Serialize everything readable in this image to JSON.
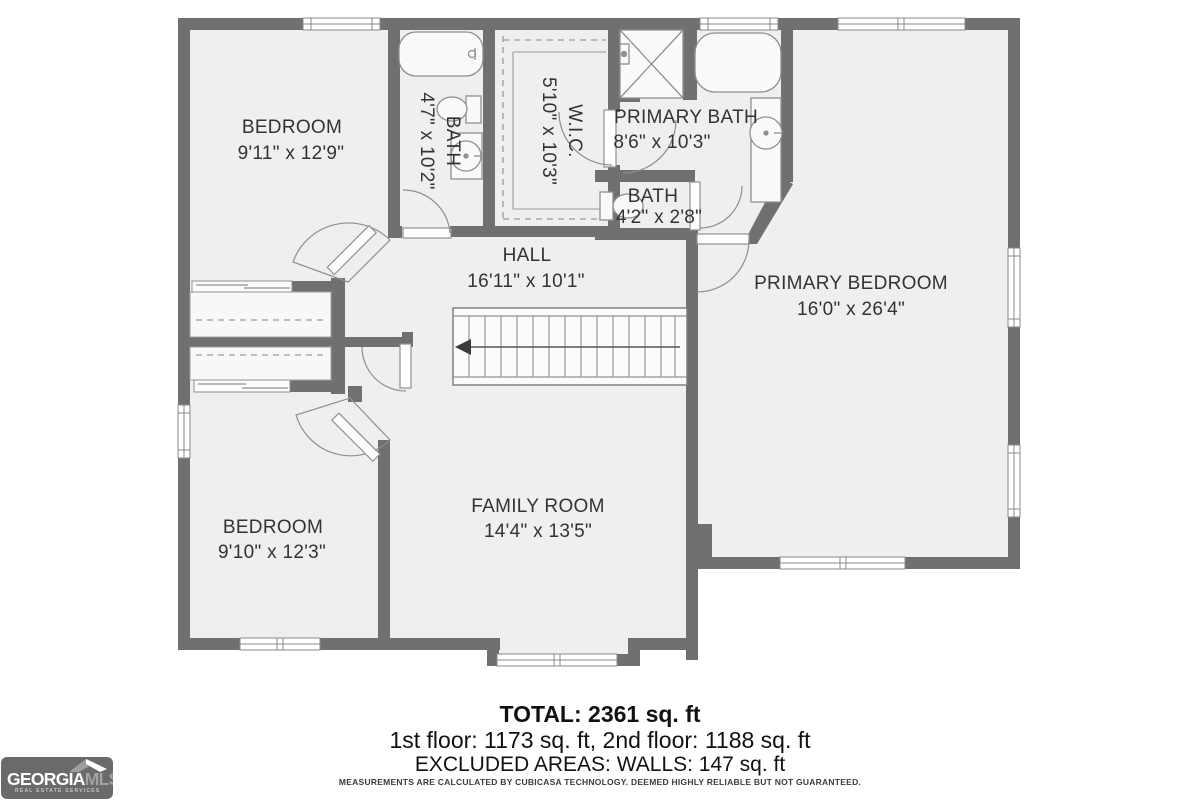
{
  "rooms": [
    {
      "id": "bedroom-top",
      "name": "BEDROOM",
      "dims": "9'11\" x 12'9\""
    },
    {
      "id": "bath-top",
      "name": "BATH",
      "dims": "4'7\" x 10'2\""
    },
    {
      "id": "wic",
      "name": "W.I.C.",
      "dims": "5'10\" x 10'3\""
    },
    {
      "id": "primary-bath",
      "name": "PRIMARY BATH",
      "dims": "8'6\" x 10'3\""
    },
    {
      "id": "bath-small",
      "name": "BATH",
      "dims": "4'2\" x 2'8\""
    },
    {
      "id": "hall",
      "name": "HALL",
      "dims": "16'11\" x 10'1\""
    },
    {
      "id": "primary-bedroom",
      "name": "PRIMARY BEDROOM",
      "dims": "16'0\" x 26'4\""
    },
    {
      "id": "bedroom-bottom",
      "name": "BEDROOM",
      "dims": "9'10\" x 12'3\""
    },
    {
      "id": "family-room",
      "name": "FAMILY ROOM",
      "dims": "14'4\" x 13'5\""
    }
  ],
  "summary": {
    "total": "TOTAL: 2361 sq. ft",
    "floors": "1st floor: 1173 sq. ft, 2nd floor: 1188 sq. ft",
    "excluded": "EXCLUDED AREAS: WALLS: 147 sq. ft",
    "disclaimer": "MEASUREMENTS ARE CALCULATED BY CUBICASA TECHNOLOGY. DEEMED HIGHLY RELIABLE BUT NOT GUARANTEED."
  },
  "logo": {
    "brand_primary": "GEORGIA",
    "brand_secondary": "MLS",
    "tagline": "REAL ESTATE SERVICES"
  },
  "colors": {
    "wall": "#707070",
    "floor": "#efefef",
    "fixture_outline": "#8f8f8f",
    "label_text": "#333333",
    "logo_background": "#6a6a6a",
    "logo_secondary_text": "#a2a2a2"
  }
}
